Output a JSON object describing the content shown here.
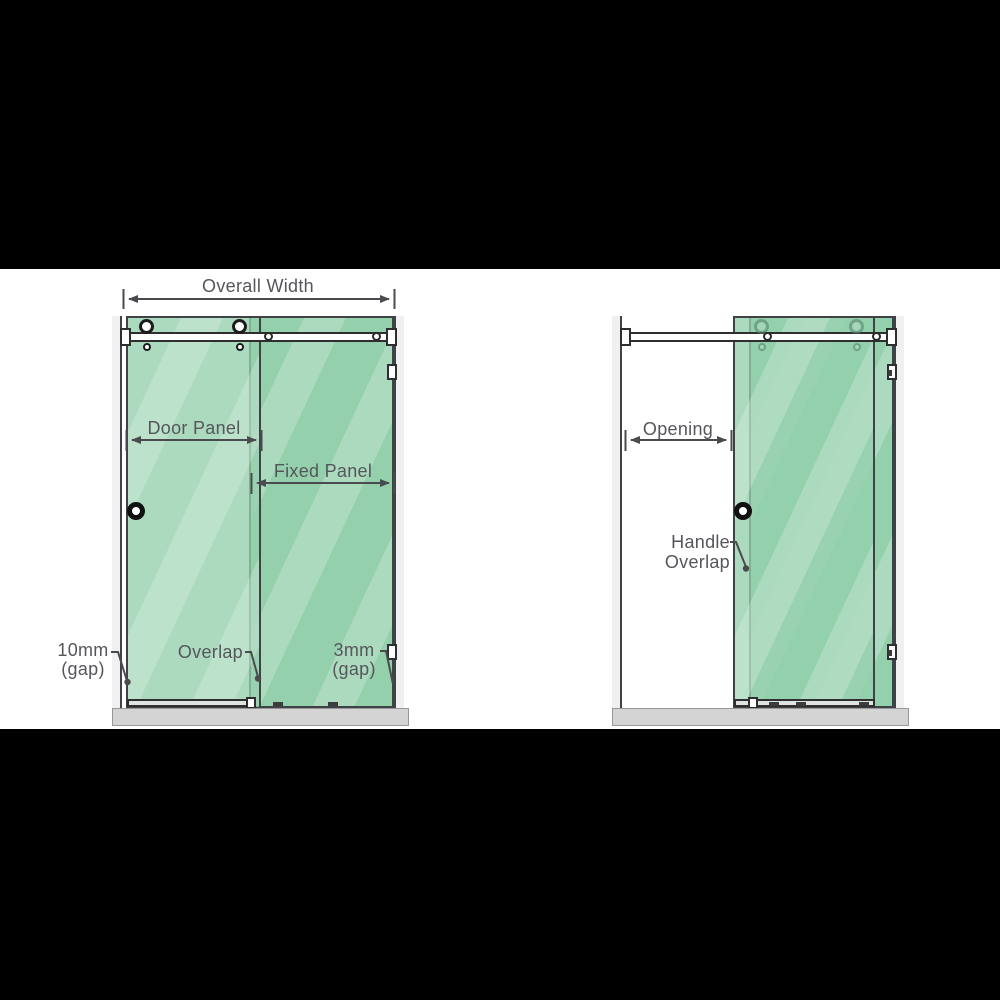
{
  "diagram_title": "Sliding shower screen measurement diagram",
  "labels": {
    "overall_width": "Overall Width",
    "door_panel": "Door Panel",
    "fixed_panel": "Fixed Panel",
    "gap_left_line1": "10mm",
    "gap_left_line2": "(gap)",
    "overlap": "Overlap",
    "gap_right_line1": "3mm",
    "gap_right_line2": "(gap)",
    "opening": "Opening",
    "handle_overlap_line1": "Handle",
    "handle_overlap_line2": "Overlap"
  },
  "colors": {
    "glass_green": "#94d0ac",
    "glass_green_door": "rgba(148,208,172,0.78)",
    "outline": "#3f4347",
    "label_text": "#55565b",
    "dimension_lines": "#4a4b4f",
    "base_gray": "#d4d4d4",
    "wall_gray": "#f0f0f0",
    "letterbox_black": "#000000"
  }
}
